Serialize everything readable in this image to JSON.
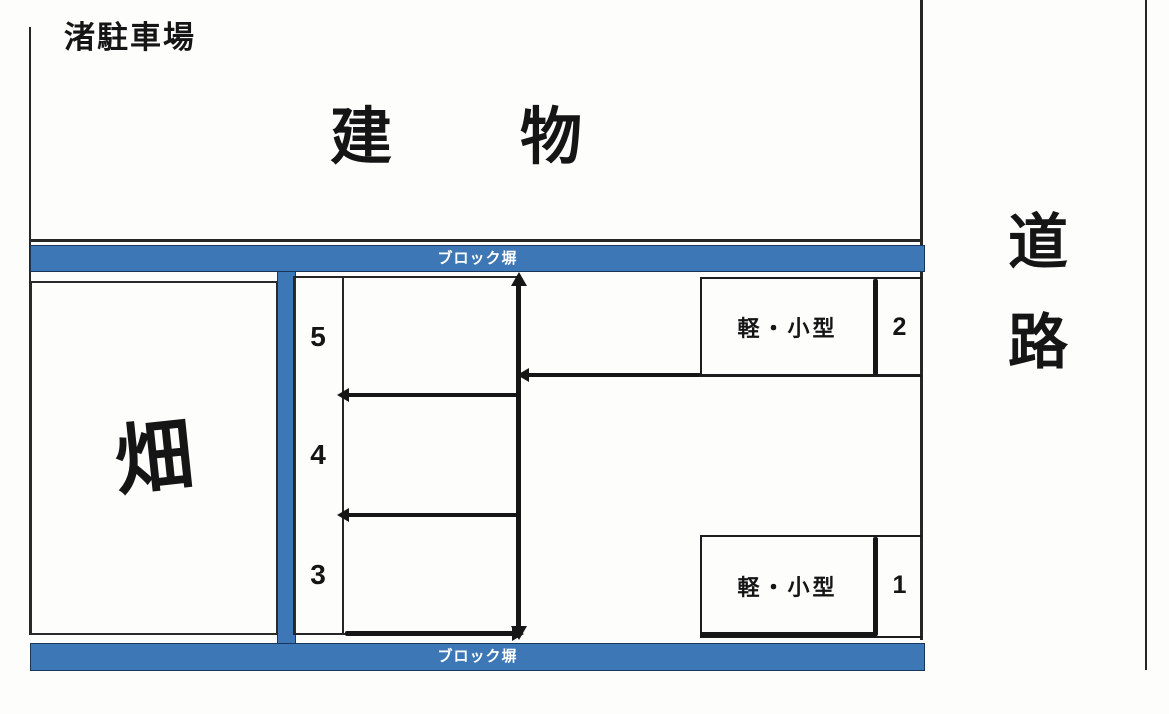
{
  "title": "渚駐車場",
  "building": {
    "label": "建物"
  },
  "road": {
    "line1": "道",
    "line2": "路"
  },
  "walls": {
    "top": {
      "label": "ブロック塀"
    },
    "bottom": {
      "label": "ブロック塀"
    }
  },
  "field": {
    "label": "畑"
  },
  "stalls": {
    "column": [
      {
        "number": "5"
      },
      {
        "number": "4"
      },
      {
        "number": "3"
      }
    ],
    "right": [
      {
        "number": "2",
        "type": "軽・小型"
      },
      {
        "number": "1",
        "type": "軽・小型"
      }
    ]
  },
  "colors": {
    "wall_blue": "#3d77b6",
    "wall_border": "#17365a",
    "line_black": "#1d1d1d"
  }
}
